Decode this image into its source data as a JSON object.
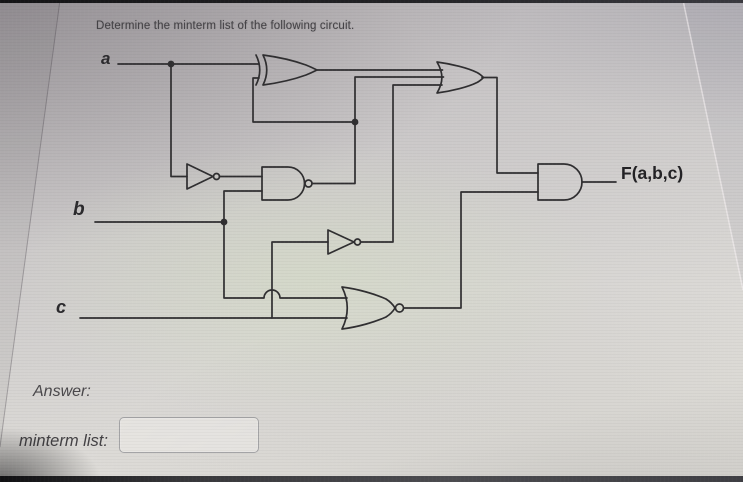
{
  "question": {
    "prompt": "Determine the minterm list of the following circuit."
  },
  "circuit": {
    "inputs": [
      {
        "id": "a",
        "label": "a"
      },
      {
        "id": "b",
        "label": "b"
      },
      {
        "id": "c",
        "label": "c"
      }
    ],
    "output_label": "F(a,b,c)",
    "gates": [
      {
        "id": "not1",
        "type": "NOT",
        "inputs": [
          "a"
        ],
        "output": "na"
      },
      {
        "id": "nand1",
        "type": "NAND",
        "inputs": [
          "na",
          "b"
        ],
        "output": "g1"
      },
      {
        "id": "xor1",
        "type": "XOR",
        "inputs": [
          "a",
          "g1"
        ],
        "output": "x1"
      },
      {
        "id": "not2",
        "type": "NOT",
        "inputs": [
          "c"
        ],
        "output": "nc"
      },
      {
        "id": "or1",
        "type": "OR",
        "inputs": [
          "x1",
          "g1",
          "nc"
        ],
        "output": "o1"
      },
      {
        "id": "nor1",
        "type": "NOR",
        "inputs": [
          "b",
          "c"
        ],
        "output": "n1"
      },
      {
        "id": "and1",
        "type": "AND",
        "inputs": [
          "o1",
          "n1"
        ],
        "output": "F(a,b,c)"
      }
    ]
  },
  "answer_section": {
    "answer_label": "Answer:",
    "minterm_list_label": "minterm list:",
    "minterm_input_value": "",
    "minterm_input_placeholder": ""
  }
}
